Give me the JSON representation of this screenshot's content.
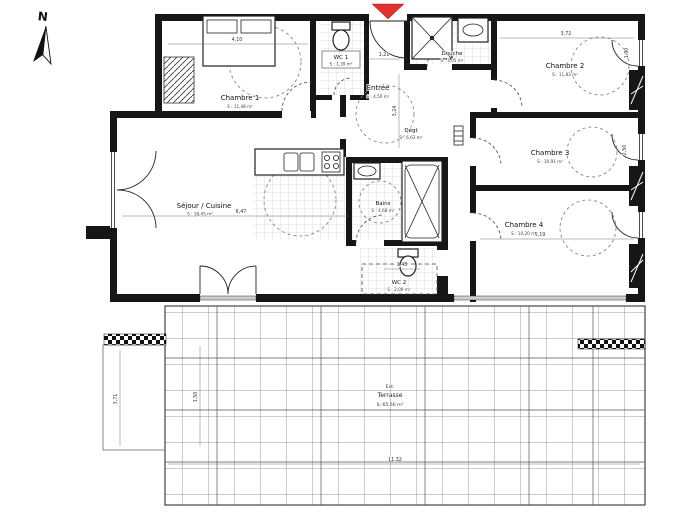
{
  "plan": {
    "compass": {
      "label": "N"
    },
    "rooms": [
      {
        "name": "Chambre 1",
        "area": "S : 11,48 m²"
      },
      {
        "name": "WC 1",
        "area": "S : 1,39 m²"
      },
      {
        "name": "Entrée",
        "area": "S : 4,50 m²"
      },
      {
        "name": "Douche",
        "area": "S : 3,05 m²"
      },
      {
        "name": "Chambre 2",
        "area": "S : 11,83 m²"
      },
      {
        "name": "Dégt",
        "area": "S : 6,63 m²"
      },
      {
        "name": "Chambre 3",
        "area": "S : 10,91 m²"
      },
      {
        "name": "Bains",
        "area": "S : 4,68 m²"
      },
      {
        "name": "Chambre 4",
        "area": "S : 10,20 m²"
      },
      {
        "name": "WC 2",
        "area": "S : 2,09 m²"
      },
      {
        "name": "Séjour / Cuisine",
        "area": "S : 38,45 m²"
      }
    ],
    "terrace": {
      "prefix": "Ext.",
      "name": "Terrasse",
      "area": "S: 65,60 m²"
    },
    "dimensions": [
      "4,10",
      "3,72",
      "1,90",
      "1,21",
      "3,24",
      "6,47",
      "2,50",
      "5,19",
      "1,48",
      "11,32",
      "3,71",
      "1,50"
    ],
    "colors": {
      "wall": "#161616",
      "entrance_marker": "#e03131",
      "tile_grid": "#c4c4c4",
      "terrace_grid": "#999999",
      "dashed_arc": "#555555"
    }
  }
}
